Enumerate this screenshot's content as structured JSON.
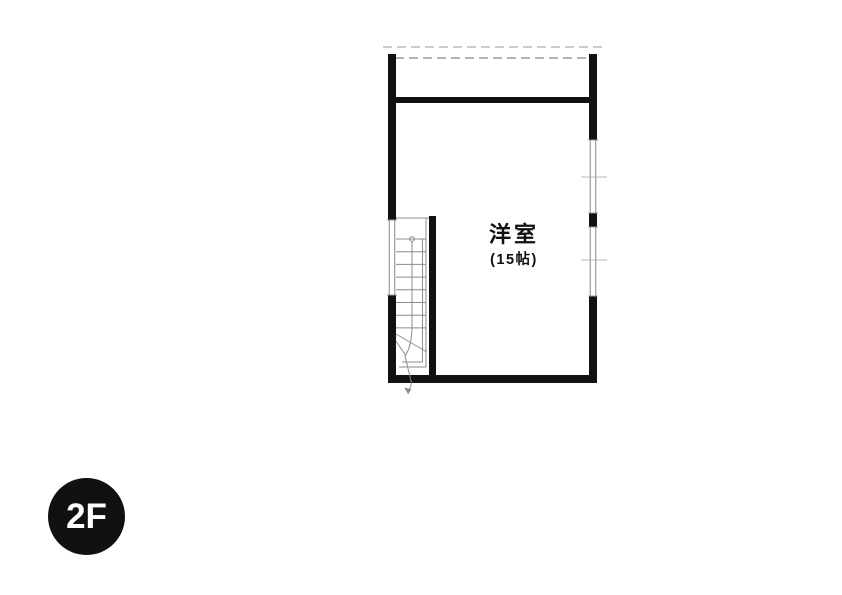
{
  "floor_badge": {
    "label": "2F"
  },
  "room": {
    "name": "洋室",
    "size": "(15帖)"
  },
  "stairs": {
    "direction_marker": "down-arrow"
  },
  "colors": {
    "background": "#ffffff",
    "wall": "#111111",
    "window": "#9a9a9a",
    "tick": "#b8b8b8",
    "dashed": "#9a9a9a",
    "dashed_light": "#bcbcbc",
    "stair": "#8c8c8c",
    "text": "#111111",
    "badge_bg": "#111111",
    "badge_text": "#ffffff"
  }
}
